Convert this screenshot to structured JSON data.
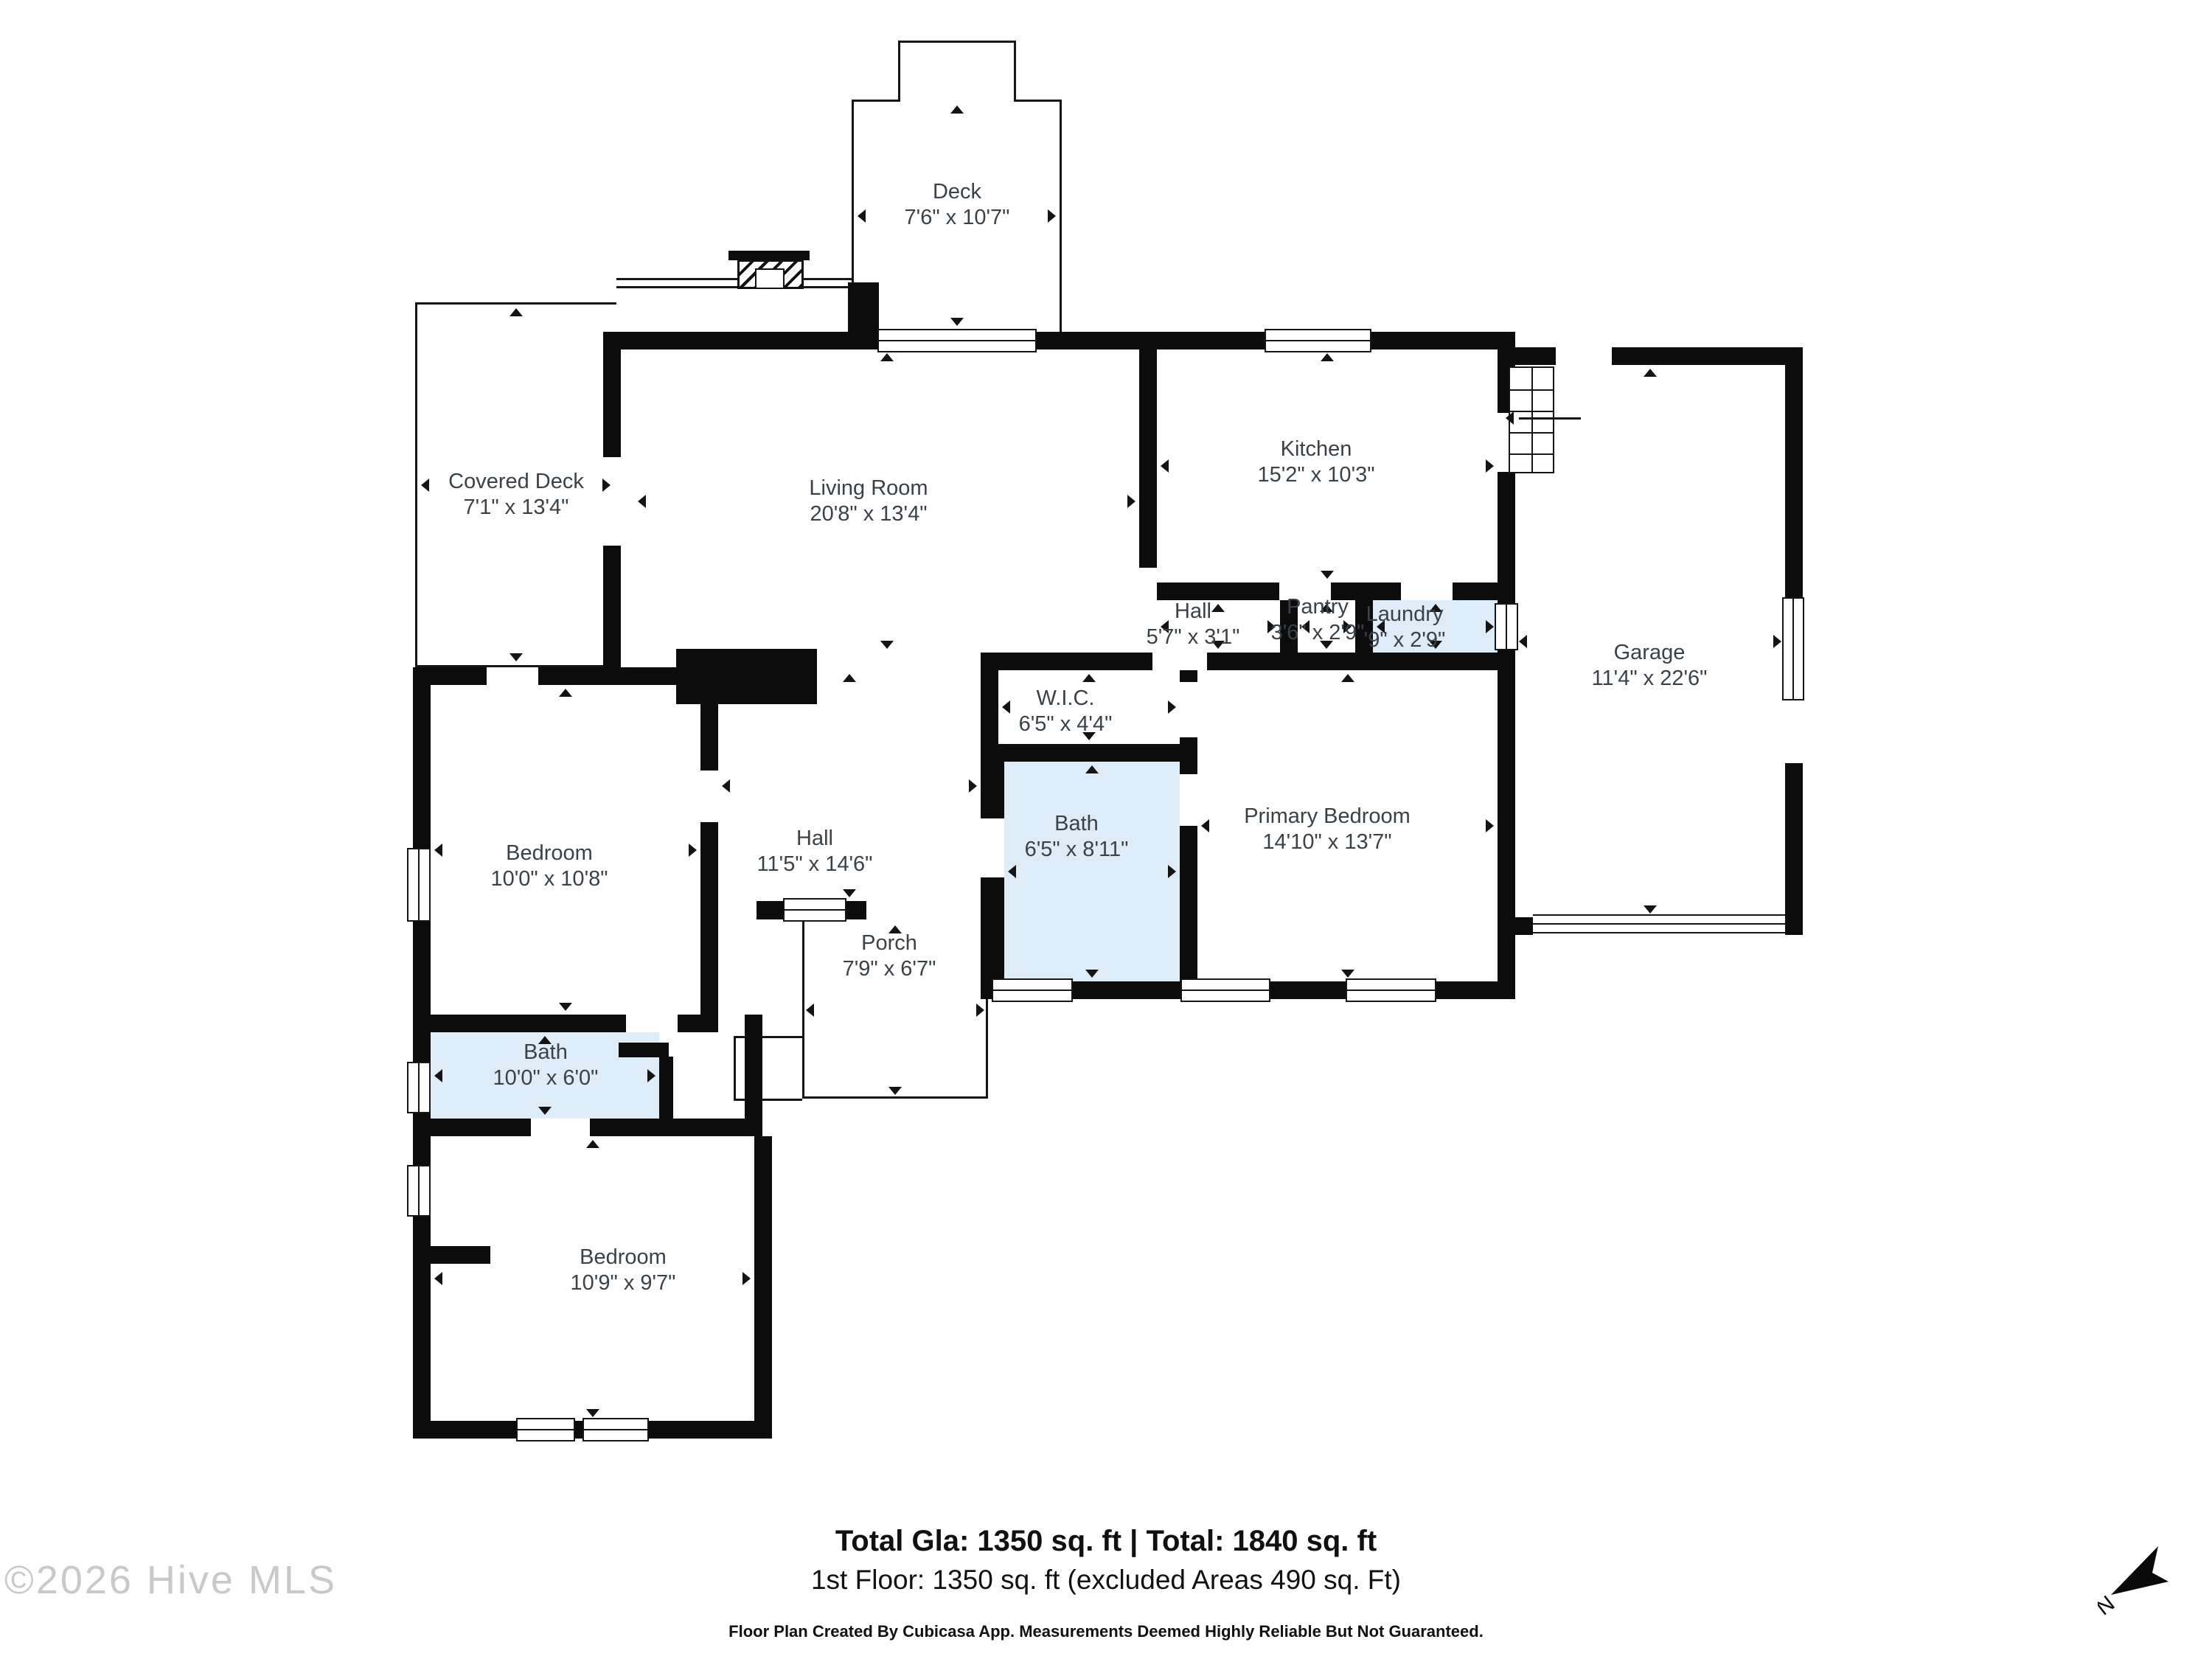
{
  "meta": {
    "bg_color": "#ffffff",
    "wall_color": "#0c0c0c",
    "bath_fill_color": "#deecf7",
    "label_color": "#3b4148"
  },
  "rooms": {
    "deck": {
      "name": "Deck",
      "dims": "7'6\" x 10'7\""
    },
    "covered_deck": {
      "name": "Covered Deck",
      "dims": "7'1\" x 13'4\""
    },
    "living_room": {
      "name": "Living Room",
      "dims": "20'8\" x 13'4\""
    },
    "kitchen": {
      "name": "Kitchen",
      "dims": "15'2\" x 10'3\""
    },
    "hall_small": {
      "name": "Hall",
      "dims": "5'7\" x 3'1\""
    },
    "pantry": {
      "name": "Pantry",
      "dims": "3'6\" x 2'9\""
    },
    "laundry": {
      "name": "Laundry",
      "dims": "'9\" x 2'9\""
    },
    "garage": {
      "name": "Garage",
      "dims": "11'4\" x 22'6\""
    },
    "wic": {
      "name": "W.I.C.",
      "dims": "6'5\" x 4'4\""
    },
    "bath_mid": {
      "name": "Bath",
      "dims": "6'5\" x 8'11\""
    },
    "primary_bedroom": {
      "name": "Primary Bedroom",
      "dims": "14'10\" x 13'7\""
    },
    "hall_big": {
      "name": "Hall",
      "dims": "11'5\" x 14'6\""
    },
    "porch": {
      "name": "Porch",
      "dims": "7'9\" x 6'7\""
    },
    "bath_left": {
      "name": "Bath",
      "dims": "10'0\" x 6'0\""
    },
    "bedroom_left": {
      "name": "Bedroom",
      "dims": "10'0\" x 10'8\""
    },
    "bedroom_bottom": {
      "name": "Bedroom",
      "dims": "10'9\" x 9'7\""
    }
  },
  "footer": {
    "totals_bold": "Total Gla: 1350 sq. ft | Total: 1840 sq. ft",
    "floor_line": "1st Floor: 1350 sq. ft (excluded Areas 490 sq. Ft)",
    "disclaimer": "Floor Plan Created By Cubicasa App. Measurements Deemed Highly Reliable But Not Guaranteed."
  },
  "watermark": "©2026 Hive MLS",
  "compass": {
    "label": "N"
  }
}
